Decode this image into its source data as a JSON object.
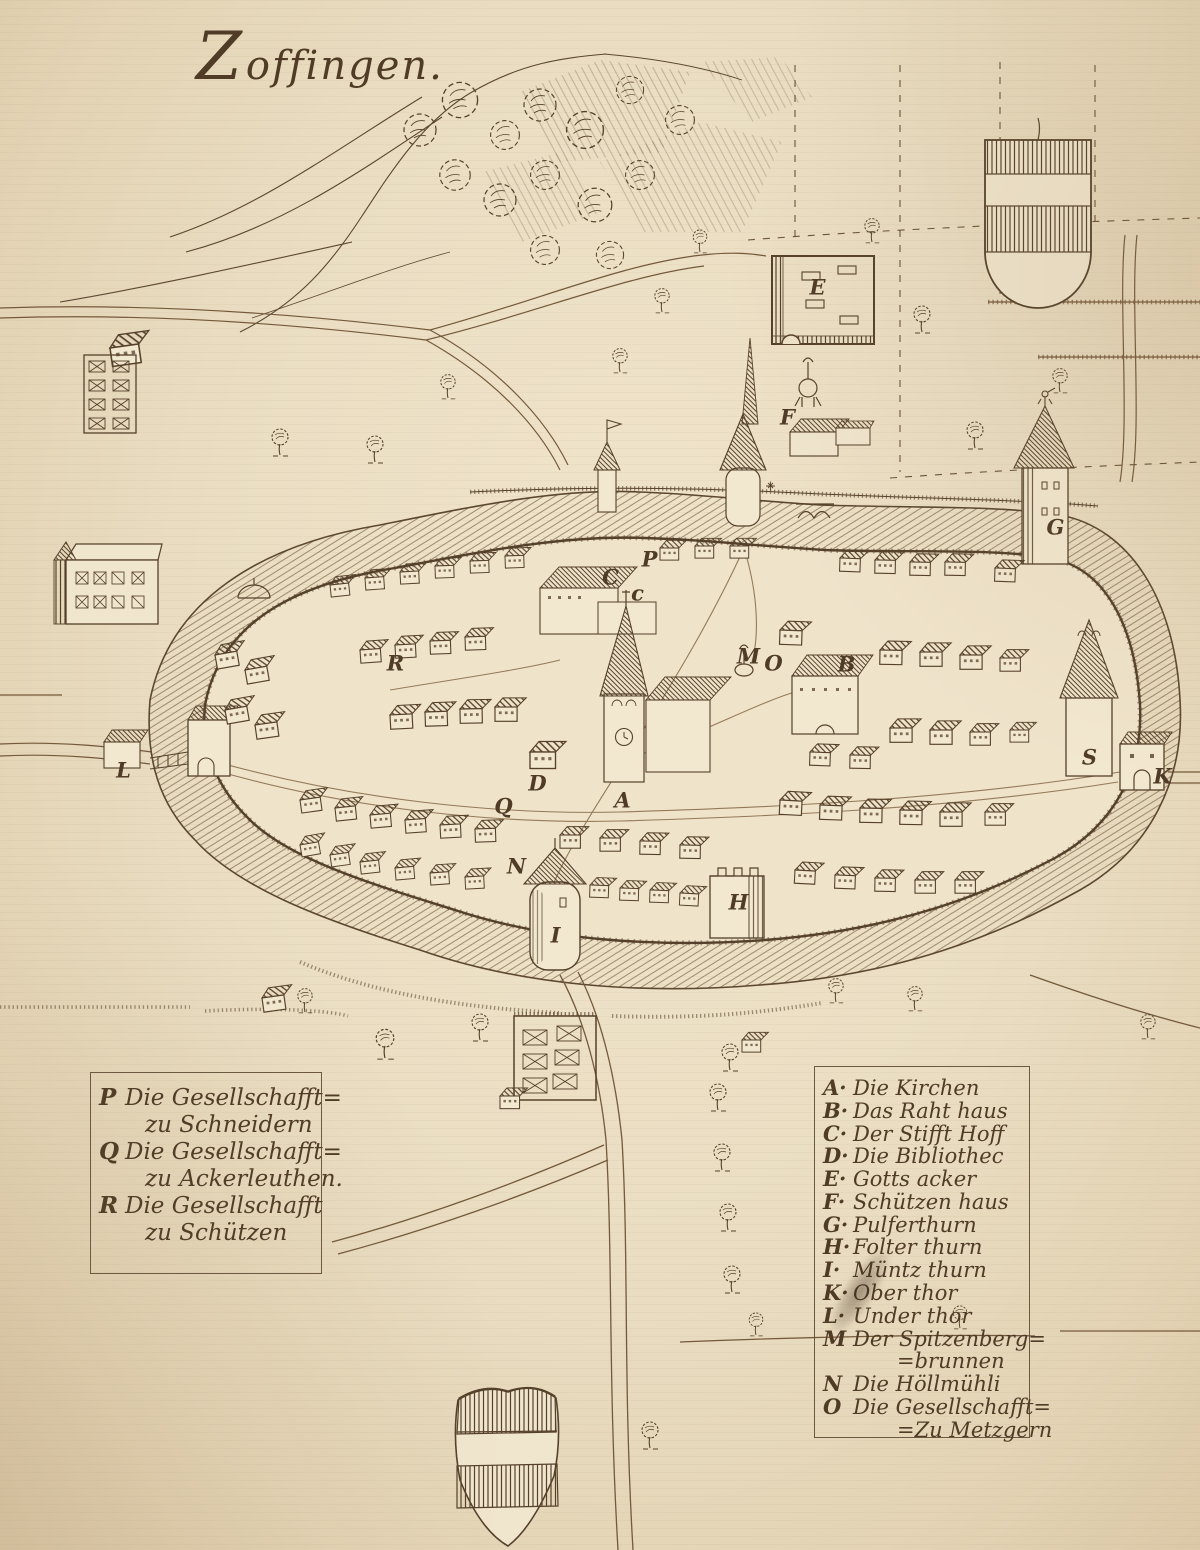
{
  "title": "Zoffingen.",
  "map": {
    "markers": [
      {
        "letter": "E",
        "x": 818,
        "y": 288
      },
      {
        "letter": "F",
        "x": 788,
        "y": 418
      },
      {
        "letter": "G",
        "x": 1056,
        "y": 528
      },
      {
        "letter": "P",
        "x": 650,
        "y": 560
      },
      {
        "letter": "C",
        "x": 611,
        "y": 578
      },
      {
        "letter": "c",
        "x": 638,
        "y": 594
      },
      {
        "letter": "R",
        "x": 396,
        "y": 664
      },
      {
        "letter": "M",
        "x": 749,
        "y": 657
      },
      {
        "letter": "O",
        "x": 774,
        "y": 664
      },
      {
        "letter": "B",
        "x": 847,
        "y": 665
      },
      {
        "letter": "D",
        "x": 538,
        "y": 784
      },
      {
        "letter": "A",
        "x": 623,
        "y": 801
      },
      {
        "letter": "Q",
        "x": 504,
        "y": 807
      },
      {
        "letter": "L",
        "x": 124,
        "y": 771
      },
      {
        "letter": "S",
        "x": 1090,
        "y": 758
      },
      {
        "letter": "K",
        "x": 1163,
        "y": 777
      },
      {
        "letter": "N",
        "x": 517,
        "y": 867
      },
      {
        "letter": "I",
        "x": 556,
        "y": 936
      },
      {
        "letter": "H",
        "x": 739,
        "y": 903
      }
    ]
  },
  "legend_left": {
    "items": [
      {
        "key": "P",
        "line1": "Die Gesellschafft=",
        "line2": "zu Schneidern"
      },
      {
        "key": "Q",
        "line1": "Die Gesellschafft=",
        "line2": "zu Ackerleuthen."
      },
      {
        "key": "R",
        "line1": "Die Gesellschafft",
        "line2": "zu Schützen"
      }
    ]
  },
  "legend_right": {
    "items": [
      {
        "key": "A·",
        "label": "Die Kirchen"
      },
      {
        "key": "B·",
        "label": "Das Raht haus"
      },
      {
        "key": "C·",
        "label": "Der Stifft Hoff"
      },
      {
        "key": "D·",
        "label": "Die Bibliothec"
      },
      {
        "key": "E·",
        "label": "Gotts acker"
      },
      {
        "key": "F·",
        "label": "Schützen haus"
      },
      {
        "key": "G·",
        "label": "Pulferthurn"
      },
      {
        "key": "H·",
        "label": "Folter thurn"
      },
      {
        "key": "I·",
        "label": "Müntz thurn"
      },
      {
        "key": "K·",
        "label": "Ober thor"
      },
      {
        "key": "L·",
        "label": "Under thor"
      },
      {
        "key": "M",
        "label": "Der Spitzenberg=",
        "sub": "=brunnen"
      },
      {
        "key": "N",
        "label": "Die Höllmühli"
      },
      {
        "key": "O",
        "label": "Die Gesellschafft=",
        "sub": "=Zu Metzgern"
      }
    ]
  },
  "colors": {
    "paper": "#eaddc2",
    "ink": "#55412b"
  }
}
